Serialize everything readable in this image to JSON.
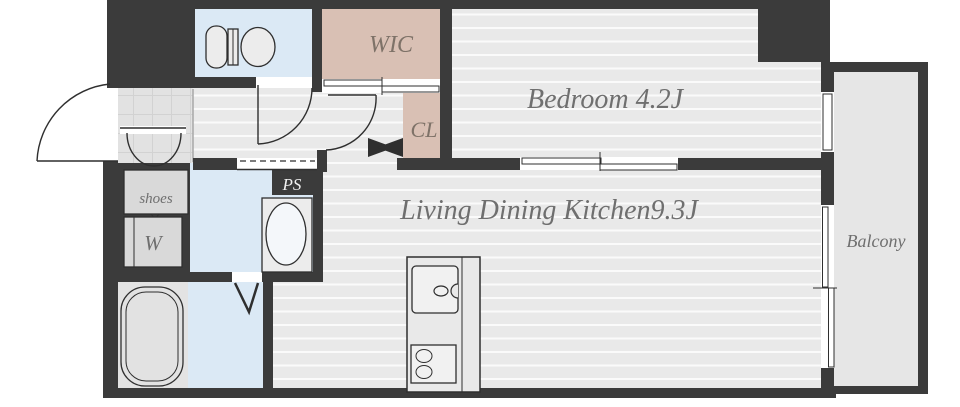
{
  "floorplan": {
    "rooms": {
      "toilet": {
        "label": ""
      },
      "wic": {
        "label": "WIC"
      },
      "closet": {
        "label": "CL"
      },
      "bedroom": {
        "label": "Bedroom 4.2J"
      },
      "ldk": {
        "label": "Living Dining Kitchen9.3J"
      },
      "balcony": {
        "label": "Balcony"
      },
      "shoes": {
        "label": "shoes"
      },
      "washer": {
        "label": "W"
      },
      "pipe_space": {
        "label": "PS"
      }
    },
    "colors": {
      "wall": "#3b3b3b",
      "floor": "#e9e9e9",
      "floor_stripe": "#fafafa",
      "water_blue": "#dbe9f5",
      "closet_beige": "#d9c0b4",
      "balcony_gray": "#e6e6e6",
      "bath_gray": "#e3e3e3",
      "label_text": "#6f6f6f",
      "closet_text": "#7e7268",
      "ps_text": "#f2f2f2"
    }
  }
}
